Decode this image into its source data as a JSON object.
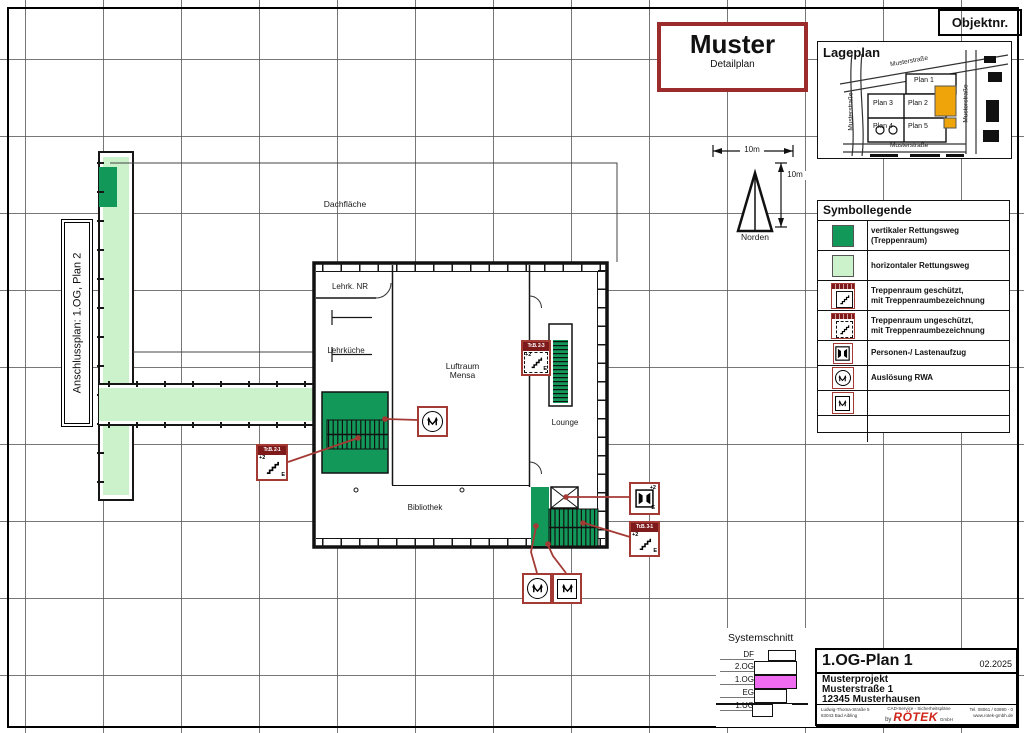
{
  "page": {
    "objektnr": "Objektnr."
  },
  "title_box": {
    "title": "Muster",
    "subtitle": "Detailplan"
  },
  "lageplan": {
    "title": "Lageplan",
    "street_top": "Musterstraße",
    "street_left": "Musterstraße",
    "street_right": "Musterstraße",
    "street_bottom": "Musterstraße",
    "plans": [
      {
        "label": "Plan 1"
      },
      {
        "label": "Plan 3"
      },
      {
        "label": "Plan 2"
      },
      {
        "label": "Plan 4"
      },
      {
        "label": "Plan 5"
      }
    ]
  },
  "legend": {
    "title": "Symbollegende",
    "items": [
      {
        "icon": "vertical-rescue-swatch",
        "label": "vertikaler Rettungsweg\n(Treppenraum)"
      },
      {
        "icon": "horizontal-rescue-swatch",
        "label": "horizontaler Rettungsweg"
      },
      {
        "icon": "stair-protected-icon",
        "label": "Treppenraum geschützt,\nmit Treppenraumbezeichnung"
      },
      {
        "icon": "stair-unprotected-icon",
        "label": "Treppenraum ungeschützt,\nmit Treppenraumbezeichnung"
      },
      {
        "icon": "elevator-icon",
        "label": "Personen-/ Lastenaufzug"
      },
      {
        "icon": "rwa-trigger-icon",
        "label": "Auslösung RWA"
      },
      {
        "icon": "rwa-opening-icon",
        "label": "RWA-Öffnung"
      }
    ]
  },
  "anschluss_label": "Anschlussplan: 1.OG, Plan 2",
  "compass": {
    "north_label": "Norden",
    "scale_h": "10m",
    "scale_v": "10m"
  },
  "floorplan": {
    "rooms": {
      "dachflaeche": "Dachfläche",
      "lehrk_nr": "Lehrk. NR",
      "lehrkueche": "Lehrküche",
      "luftraum_line1": "Luftraum",
      "luftraum_line2": "Mensa",
      "lounge": "Lounge",
      "bibliothek": "Bibliothek"
    },
    "callouts": {
      "stair_a": {
        "tag": "Tr.B. 2-1",
        "top": "+2",
        "bottom": "E"
      },
      "stair_b": {
        "tag": "Tr.B. 2-3",
        "top": "+2",
        "bottom": "E"
      },
      "stair_c": {
        "tag": "Tr.B. 3-1",
        "top": "+2",
        "bottom": "E"
      },
      "elevator": {
        "top": "+2",
        "bottom": "E"
      }
    }
  },
  "systemschnitt": {
    "title": "Systemschnitt",
    "levels": [
      "DF",
      "2.OG",
      "1.OG",
      "EG",
      "1.UG"
    ],
    "highlight_level": "1.OG"
  },
  "titleblock": {
    "plan_name": "1.OG-Plan 1",
    "date": "02.2025",
    "project_line1": "Musterprojekt",
    "project_line2": "Musterstraße 1",
    "project_line3": "12345 Musterhausen",
    "address_line1": "Ludwig-Thoma-Straße 5",
    "address_line2": "83043 Bad Aibling",
    "tagline": "CAD-Service - Sicherheitspläne",
    "by": "by",
    "brand": "RÖTEK",
    "brand_suffix": "GmbH",
    "phone": "Tel. 08061 / 93890 - 0",
    "web": "www.rotek-gmbh.de"
  },
  "colors": {
    "vertical_rescue_green": "#12995a",
    "horizontal_rescue_green": "#ccf2cc",
    "annotation_red": "#a43a34",
    "tag_strip_red": "#7e1a1a",
    "highlight_orange": "#efa50a",
    "level_magenta": "#ef6bef",
    "brand_red": "#cf2318"
  }
}
